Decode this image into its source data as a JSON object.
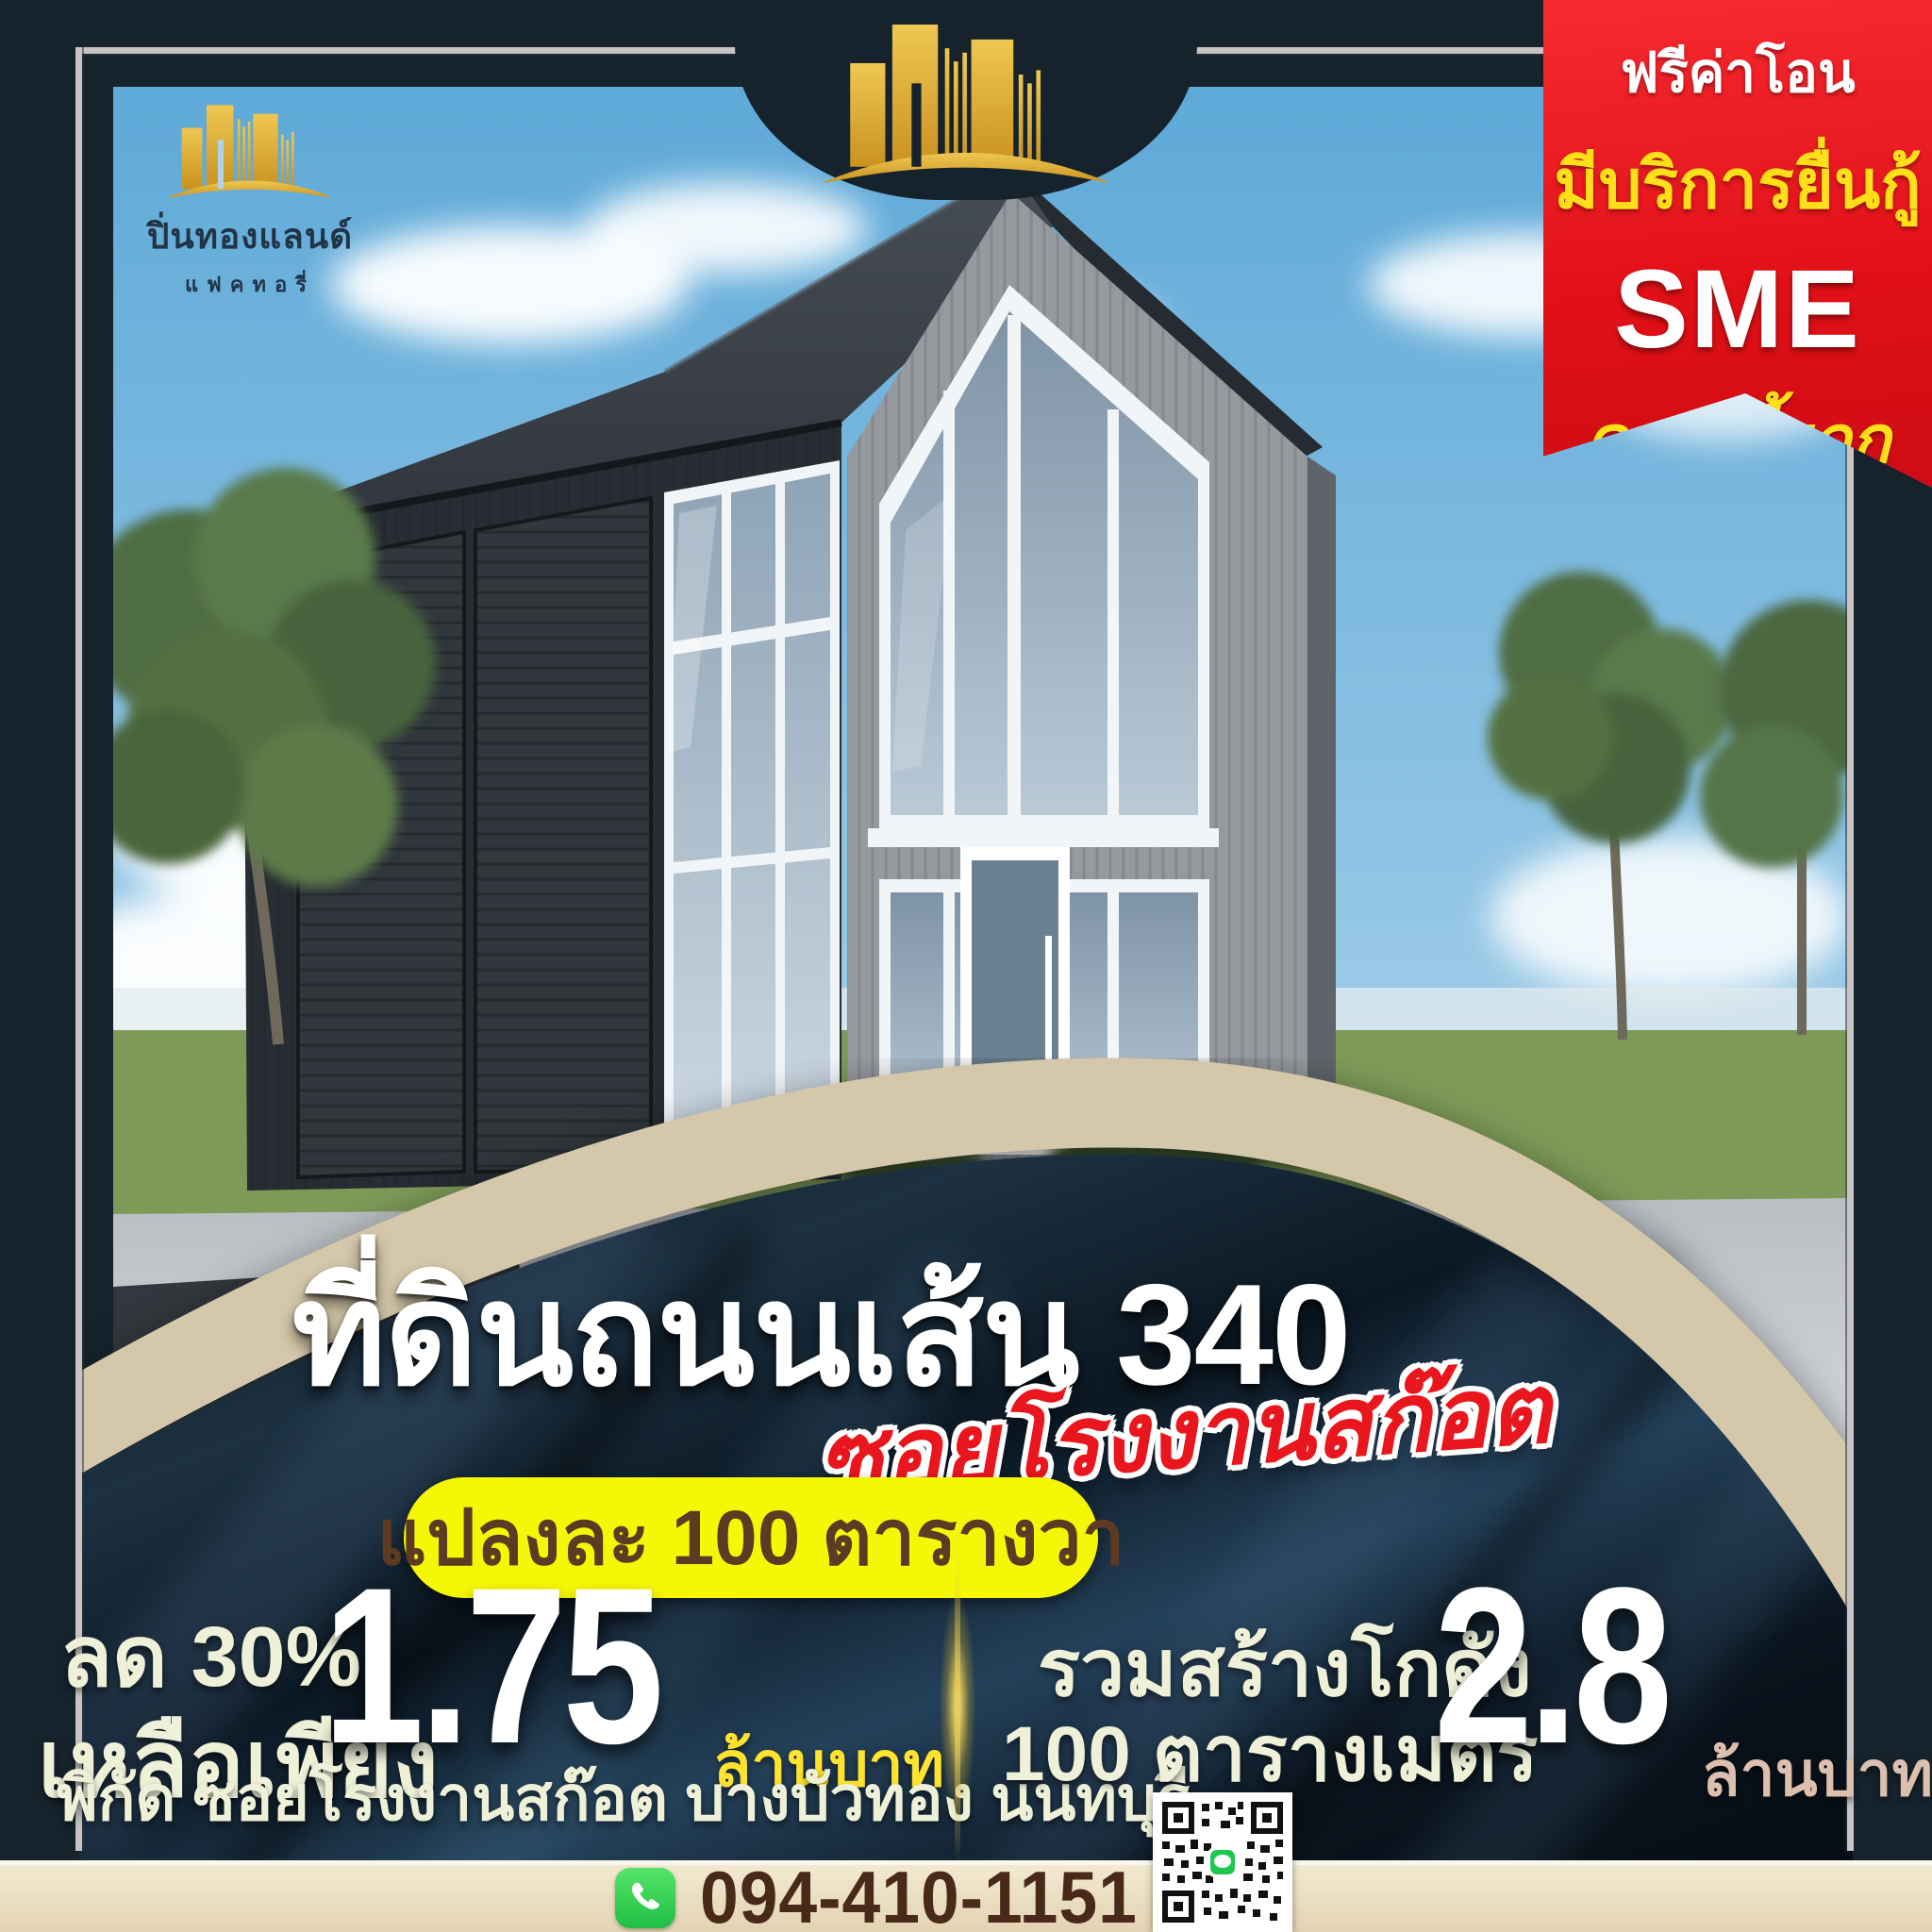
{
  "brand": {
    "icon": "gold-skyline-icon",
    "name": "ปิ่นทองแลนด์",
    "subname": "แฟคทอรี่"
  },
  "ribbon": {
    "line1": "ฟรีค่าโอน",
    "line2": "มีบริการยื่นกู้",
    "line3": "SME",
    "line4": "ดอกเบี้ยถูก"
  },
  "headline": {
    "title": "ที่ดินถนนเส้น 340",
    "subtitle": "ซอยโรงงานสก๊อต",
    "badge": "แปลงละ 100 ตารางวา"
  },
  "offer_left": {
    "discount": "ลด 30%",
    "label": "เหลือเพียง",
    "price": "1.75",
    "unit": "ล้านบาท",
    "location": "พิกัด ซอยโรงงานสก๊อต บางบัวทอง นนทบุรี"
  },
  "offer_right": {
    "label1": "รวมสร้างโกดัง",
    "label2": "100 ตารางเมตร",
    "price": "2.8",
    "unit": "ล้านบาท"
  },
  "contact": {
    "phone": "094-410-1151",
    "phone_icon": "phone-icon",
    "qr_icon": "line-qr-code"
  },
  "colors": {
    "navy": "#16232d",
    "ribbon_red": "#e11016",
    "ribbon_yellow": "#ffdf19",
    "badge_yellow": "#f6f607",
    "badge_text": "#5c3b22",
    "cream_text": "#eef0d8",
    "price_unit_yellow": "#ffe32e",
    "price_unit_pink": "#dcbfae",
    "beige_band": "#d5c7a9",
    "bottom_bar": "#e8dcc2",
    "phone_text": "#49291a",
    "phone_green": "#1fbf44",
    "frame_silver": "#c9c3c3"
  }
}
